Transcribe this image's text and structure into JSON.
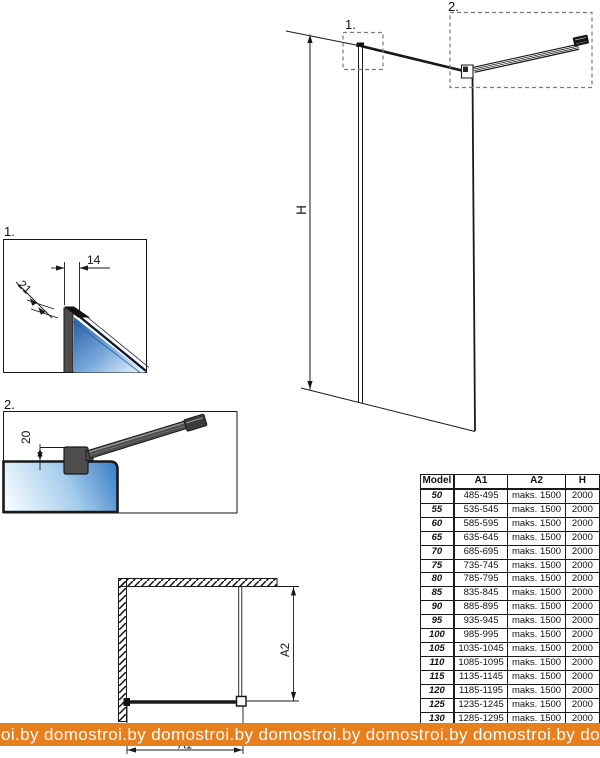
{
  "callouts": {
    "elevation_1": "1.",
    "elevation_2": "2.",
    "detail_1": "1.",
    "detail_2": "2."
  },
  "dimensions": {
    "height_label": "H",
    "width_label": "A1",
    "depth_label": "A2",
    "profile_width": "14",
    "profile_depth": "21",
    "bar_offset": "20"
  },
  "table": {
    "headers": [
      "Model",
      "A1",
      "A2",
      "H"
    ],
    "rows": [
      {
        "model": "50",
        "a1": "485-495",
        "a2": "maks. 1500",
        "h": "2000"
      },
      {
        "model": "55",
        "a1": "535-545",
        "a2": "maks. 1500",
        "h": "2000"
      },
      {
        "model": "60",
        "a1": "585-595",
        "a2": "maks. 1500",
        "h": "2000"
      },
      {
        "model": "65",
        "a1": "635-645",
        "a2": "maks. 1500",
        "h": "2000"
      },
      {
        "model": "70",
        "a1": "685-695",
        "a2": "maks. 1500",
        "h": "2000"
      },
      {
        "model": "75",
        "a1": "735-745",
        "a2": "maks. 1500",
        "h": "2000"
      },
      {
        "model": "80",
        "a1": "785-795",
        "a2": "maks. 1500",
        "h": "2000"
      },
      {
        "model": "85",
        "a1": "835-845",
        "a2": "maks. 1500",
        "h": "2000"
      },
      {
        "model": "90",
        "a1": "885-895",
        "a2": "maks. 1500",
        "h": "2000"
      },
      {
        "model": "95",
        "a1": "935-945",
        "a2": "maks. 1500",
        "h": "2000"
      },
      {
        "model": "100",
        "a1": "985-995",
        "a2": "maks. 1500",
        "h": "2000"
      },
      {
        "model": "105",
        "a1": "1035-1045",
        "a2": "maks. 1500",
        "h": "2000"
      },
      {
        "model": "110",
        "a1": "1085-1095",
        "a2": "maks. 1500",
        "h": "2000"
      },
      {
        "model": "115",
        "a1": "1135-1145",
        "a2": "maks. 1500",
        "h": "2000"
      },
      {
        "model": "120",
        "a1": "1185-1195",
        "a2": "maks. 1500",
        "h": "2000"
      },
      {
        "model": "125",
        "a1": "1235-1245",
        "a2": "maks. 1500",
        "h": "2000"
      },
      {
        "model": "130",
        "a1": "1285-1295",
        "a2": "maks. 1500",
        "h": "2000"
      }
    ]
  },
  "watermark": {
    "text": "oi.by  domostroi.by  domostroi.by  domostroi.by  domostroi.by  domostroi.by  domostroi.by",
    "color": "#e87f1e"
  },
  "colors": {
    "line_black": "#1a1a1a",
    "profile_gray": "#4d4d4d",
    "glass_blue_dark": "#3a72b8",
    "glass_blue_light": "#e9f4fc",
    "watermark_orange": "#e87f1e"
  }
}
